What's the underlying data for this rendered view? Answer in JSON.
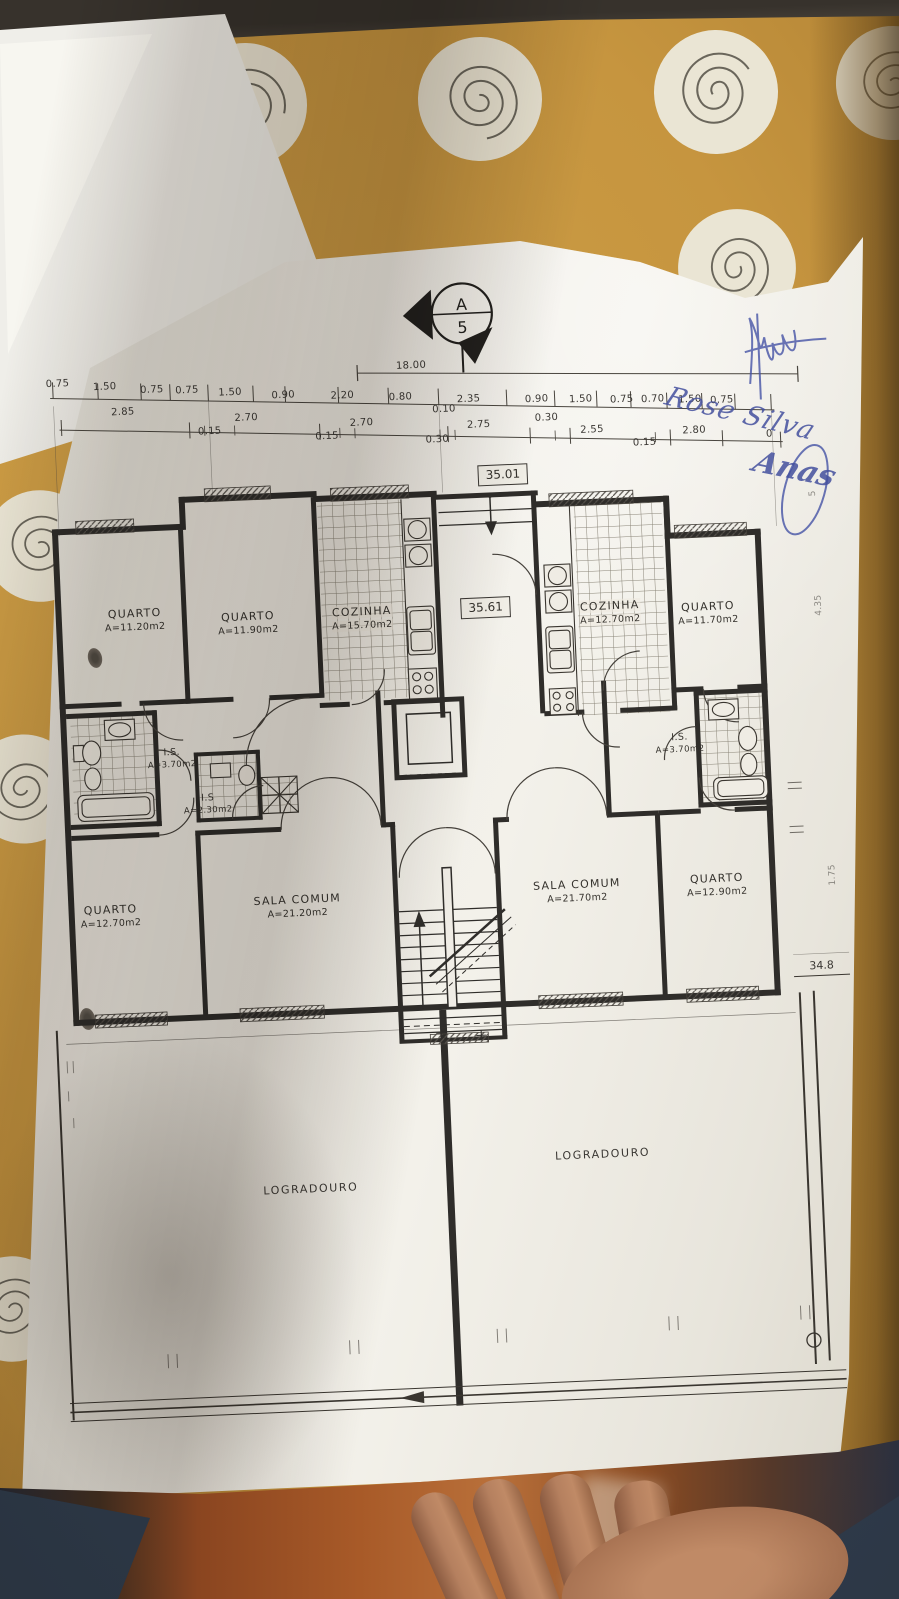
{
  "section_marker": {
    "letter": "A",
    "number": "5"
  },
  "levels": {
    "entry": "35.01",
    "hall": "35.61",
    "rear": "34.8"
  },
  "handwriting": {
    "line1": "Rose Silva",
    "line2": "Anas"
  },
  "dim_row_top": [
    {
      "t": "0.75",
      "x": 50,
      "y": 98
    },
    {
      "t": "1.50",
      "x": 97,
      "y": 103
    },
    {
      "t": "0.75",
      "x": 144,
      "y": 108
    },
    {
      "t": "0.75",
      "x": 179,
      "y": 110
    },
    {
      "t": "1.50",
      "x": 222,
      "y": 114
    },
    {
      "t": "0.90",
      "x": 275,
      "y": 119
    },
    {
      "t": "2.20",
      "x": 334,
      "y": 122
    },
    {
      "t": "0.80",
      "x": 392,
      "y": 126
    },
    {
      "t": "18.00",
      "x": 404,
      "y": 95
    },
    {
      "t": "2.35",
      "x": 460,
      "y": 131
    },
    {
      "t": "0.90",
      "x": 528,
      "y": 134
    },
    {
      "t": "1.50",
      "x": 572,
      "y": 136
    },
    {
      "t": "0.75",
      "x": 613,
      "y": 138
    },
    {
      "t": "0.70",
      "x": 644,
      "y": 139
    },
    {
      "t": "1.50",
      "x": 681,
      "y": 141
    },
    {
      "t": "0.75",
      "x": 713,
      "y": 143
    }
  ],
  "dim_row_bottom": [
    {
      "t": "2.85",
      "x": 114,
      "y": 129
    },
    {
      "t": "0.15",
      "x": 200,
      "y": 152
    },
    {
      "t": "2.70",
      "x": 237,
      "y": 140
    },
    {
      "t": "0.15",
      "x": 317,
      "y": 162
    },
    {
      "t": "2.70",
      "x": 352,
      "y": 150
    },
    {
      "t": "0.10",
      "x": 435,
      "y": 140
    },
    {
      "t": "0.30",
      "x": 427,
      "y": 170
    },
    {
      "t": "2.75",
      "x": 469,
      "y": 157
    },
    {
      "t": "0.30",
      "x": 537,
      "y": 153
    },
    {
      "t": "2.55",
      "x": 582,
      "y": 167
    },
    {
      "t": "0.15",
      "x": 634,
      "y": 182
    },
    {
      "t": "2.80",
      "x": 684,
      "y": 172
    },
    {
      "t": "0",
      "x": 759,
      "y": 179
    }
  ],
  "side_dims": [
    {
      "t": "5",
      "x": 800,
      "y": 240,
      "rot": -90
    },
    {
      "t": "4.35",
      "x": 801,
      "y": 352,
      "rot": -90
    },
    {
      "t": "1.75",
      "x": 803,
      "y": 622,
      "rot": -90
    }
  ],
  "rooms": [
    {
      "name": "QUARTO",
      "area": "A=11.20m2",
      "x": 117,
      "y": 337
    },
    {
      "name": "QUARTO",
      "area": "A=11.90m2",
      "x": 230,
      "y": 345
    },
    {
      "name": "COZINHA",
      "area": "A=15.70m2",
      "x": 344,
      "y": 345,
      "cls": "onTile"
    },
    {
      "name": "COZINHA",
      "area": "A=12.70m2",
      "x": 592,
      "y": 350,
      "cls": "onTile"
    },
    {
      "name": "QUARTO",
      "area": "A=11.70m2",
      "x": 690,
      "y": 355
    },
    {
      "name": "I.S.",
      "area": "A=3.70m2",
      "x": 148,
      "y": 477,
      "cls": "sm"
    },
    {
      "name": "I.S",
      "area": "A=2.30m2",
      "x": 182,
      "y": 524,
      "cls": "sm"
    },
    {
      "name": "I.S.",
      "area": "A=3.70m2",
      "x": 656,
      "y": 484,
      "cls": "sm"
    },
    {
      "name": "QUARTO",
      "area": "A=12.70m2",
      "x": 80,
      "y": 632
    },
    {
      "name": "SALA COMUM",
      "area": "A=21.20m2",
      "x": 267,
      "y": 630
    },
    {
      "name": "SALA COMUM",
      "area": "A=21.70m2",
      "x": 547,
      "y": 627
    },
    {
      "name": "QUARTO",
      "area": "A=12.90m2",
      "x": 687,
      "y": 627
    }
  ],
  "yards": [
    {
      "t": "LOGRADOURO",
      "x": 268,
      "y": 913
    },
    {
      "t": "LOGRADOURO",
      "x": 561,
      "y": 891
    }
  ]
}
